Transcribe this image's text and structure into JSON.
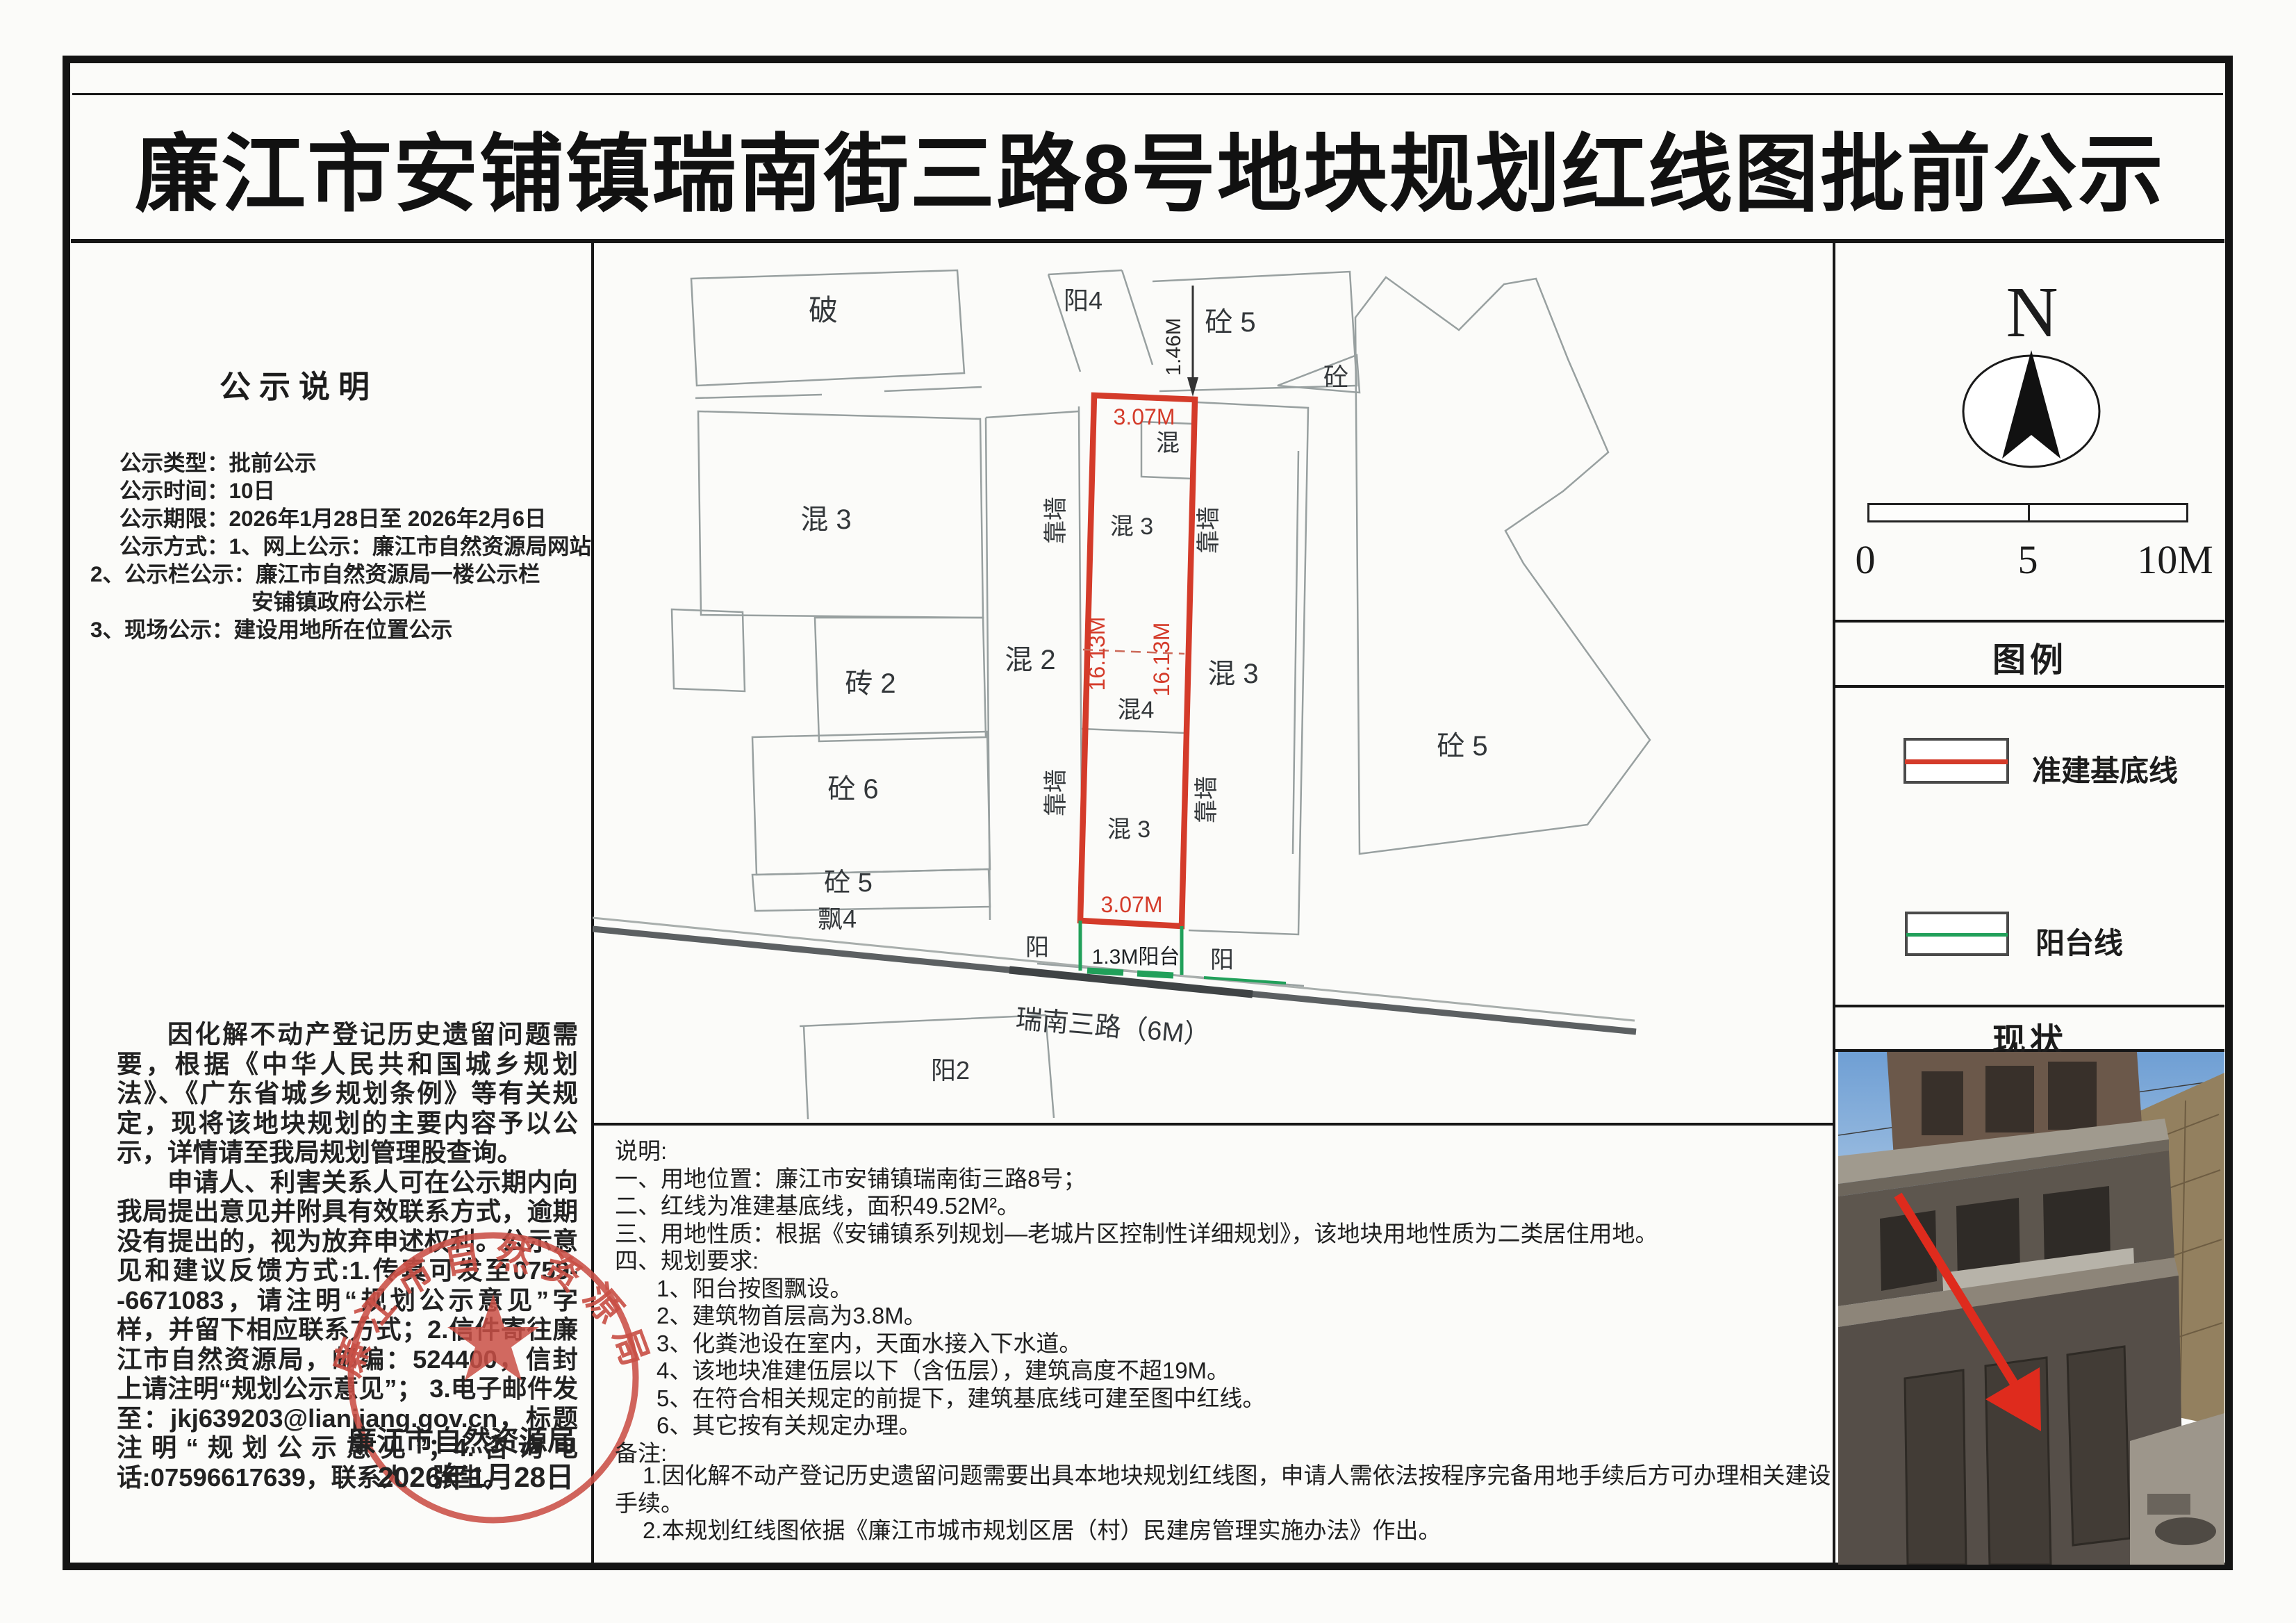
{
  "title": "廉江市安铺镇瑞南街三路8号地块规划红线图批前公示",
  "left_panel": {
    "heading": "公示说明",
    "info_lines": [
      "公示类型：批前公示",
      "公示时间：10日",
      "公示期限：2026年1月28日至 2026年2月6日",
      "公示方式：1、网上公示：廉江市自然资源局网站",
      "2、公示栏公示：廉江市自然资源局一楼公示栏",
      "安铺镇政府公示栏",
      "3、现场公示：建设用地所在位置公示"
    ],
    "para1": "因化解不动产登记历史遗留问题需要，根据《中华人民共和国城乡规划法》、《广东省城乡规划条例》等有关规定，现将该地块规划的主要内容予以公示，详情请至我局规划管理股查询。",
    "para2": "申请人、利害关系人可在公示期内向我局提出意见并附具有效联系方式，逾期没有提出的，视为放弃申述权利。公示意见和建议反馈方式:1.传真可发至0759--6671083，请注明“规划公示意见”字样，并留下相应联系方式；2.信件寄往廉江市自然资源局，邮编：524400，信封上请注明“规划公示意见”； 3.电子邮件发至：jkj639203@lianjiang.gov.cn，标题注明“规划公示意见”；4.咨询电话:07596617639，联系人：张生。",
    "stamp": {
      "seal_text": "廉江市自然资源局",
      "agency": "廉江市自然资源局",
      "date": "2026年1月28日"
    }
  },
  "map": {
    "labels": {
      "po": "破",
      "yang4": "阳4",
      "tong5_top": "砼 5",
      "tong": "砼",
      "dim146": "1.46M",
      "hun3_left": "混 3",
      "zhuan2": "砖 2",
      "hun2": "混 2",
      "tong6": "砼 6",
      "tong5_left": "砼 5",
      "piao4": "飘4",
      "kq_ul": "靠墙",
      "kq_ur": "靠墙",
      "kq_ll": "靠墙",
      "kq_lr": "靠墙",
      "hun_small": "混",
      "hun3_plot_upper": "混 3",
      "hun4": "混4",
      "hun3_plot_lower": "混 3",
      "hun3_right": "混 3",
      "tong5_right": "砼 5",
      "dim307_top": "3.07M",
      "dim307_bottom": "3.07M",
      "dim1613_left": "16.13M",
      "dim1613_right": "16.13M",
      "yang_left": "阳",
      "balcony": "1.3M阳台",
      "yang_right": "阳",
      "road": "瑞南三路（6M）",
      "yang2": "阳2"
    },
    "colors": {
      "red_line": "#d43b2a",
      "green_line": "#21a05a"
    }
  },
  "right_panel": {
    "north_label": "N",
    "scale_ticks": [
      "0",
      "5",
      "10M"
    ],
    "legend_header": "图例",
    "legend": [
      {
        "label": "准建基底线",
        "color": "#d43b2a"
      },
      {
        "label": "阳台线",
        "color": "#21a05a"
      }
    ],
    "status_header": "现状"
  },
  "notes": {
    "heading": "说明:",
    "items": [
      "一、用地位置：廉江市安铺镇瑞南街三路8号；",
      "二、红线为准建基底线，面积49.52M²。",
      "三、用地性质：根据《安铺镇系列规划—老城片区控制性详细规划》，该地块用地性质为二类居住用地。",
      "四、规划要求:",
      "1、阳台按图飘设。",
      "2、建筑物首层高为3.8M。",
      "3、化粪池设在室内，天面水接入下水道。",
      "4、该地块准建伍层以下（含伍层），建筑高度不超19M。",
      "5、在符合相关规定的前提下，建筑基底线可建至图中红线。",
      "6、其它按有关规定办理。"
    ],
    "remark_heading": "备注:",
    "remarks": [
      "1.因化解不动产登记历史遗留问题需要出具本地块规划红线图，申请人需依法按程序完备用地手续后方可办理相关建设手续。",
      "2.本规划红线图依据《廉江市城市规划区居（村）民建房管理实施办法》作出。"
    ]
  }
}
